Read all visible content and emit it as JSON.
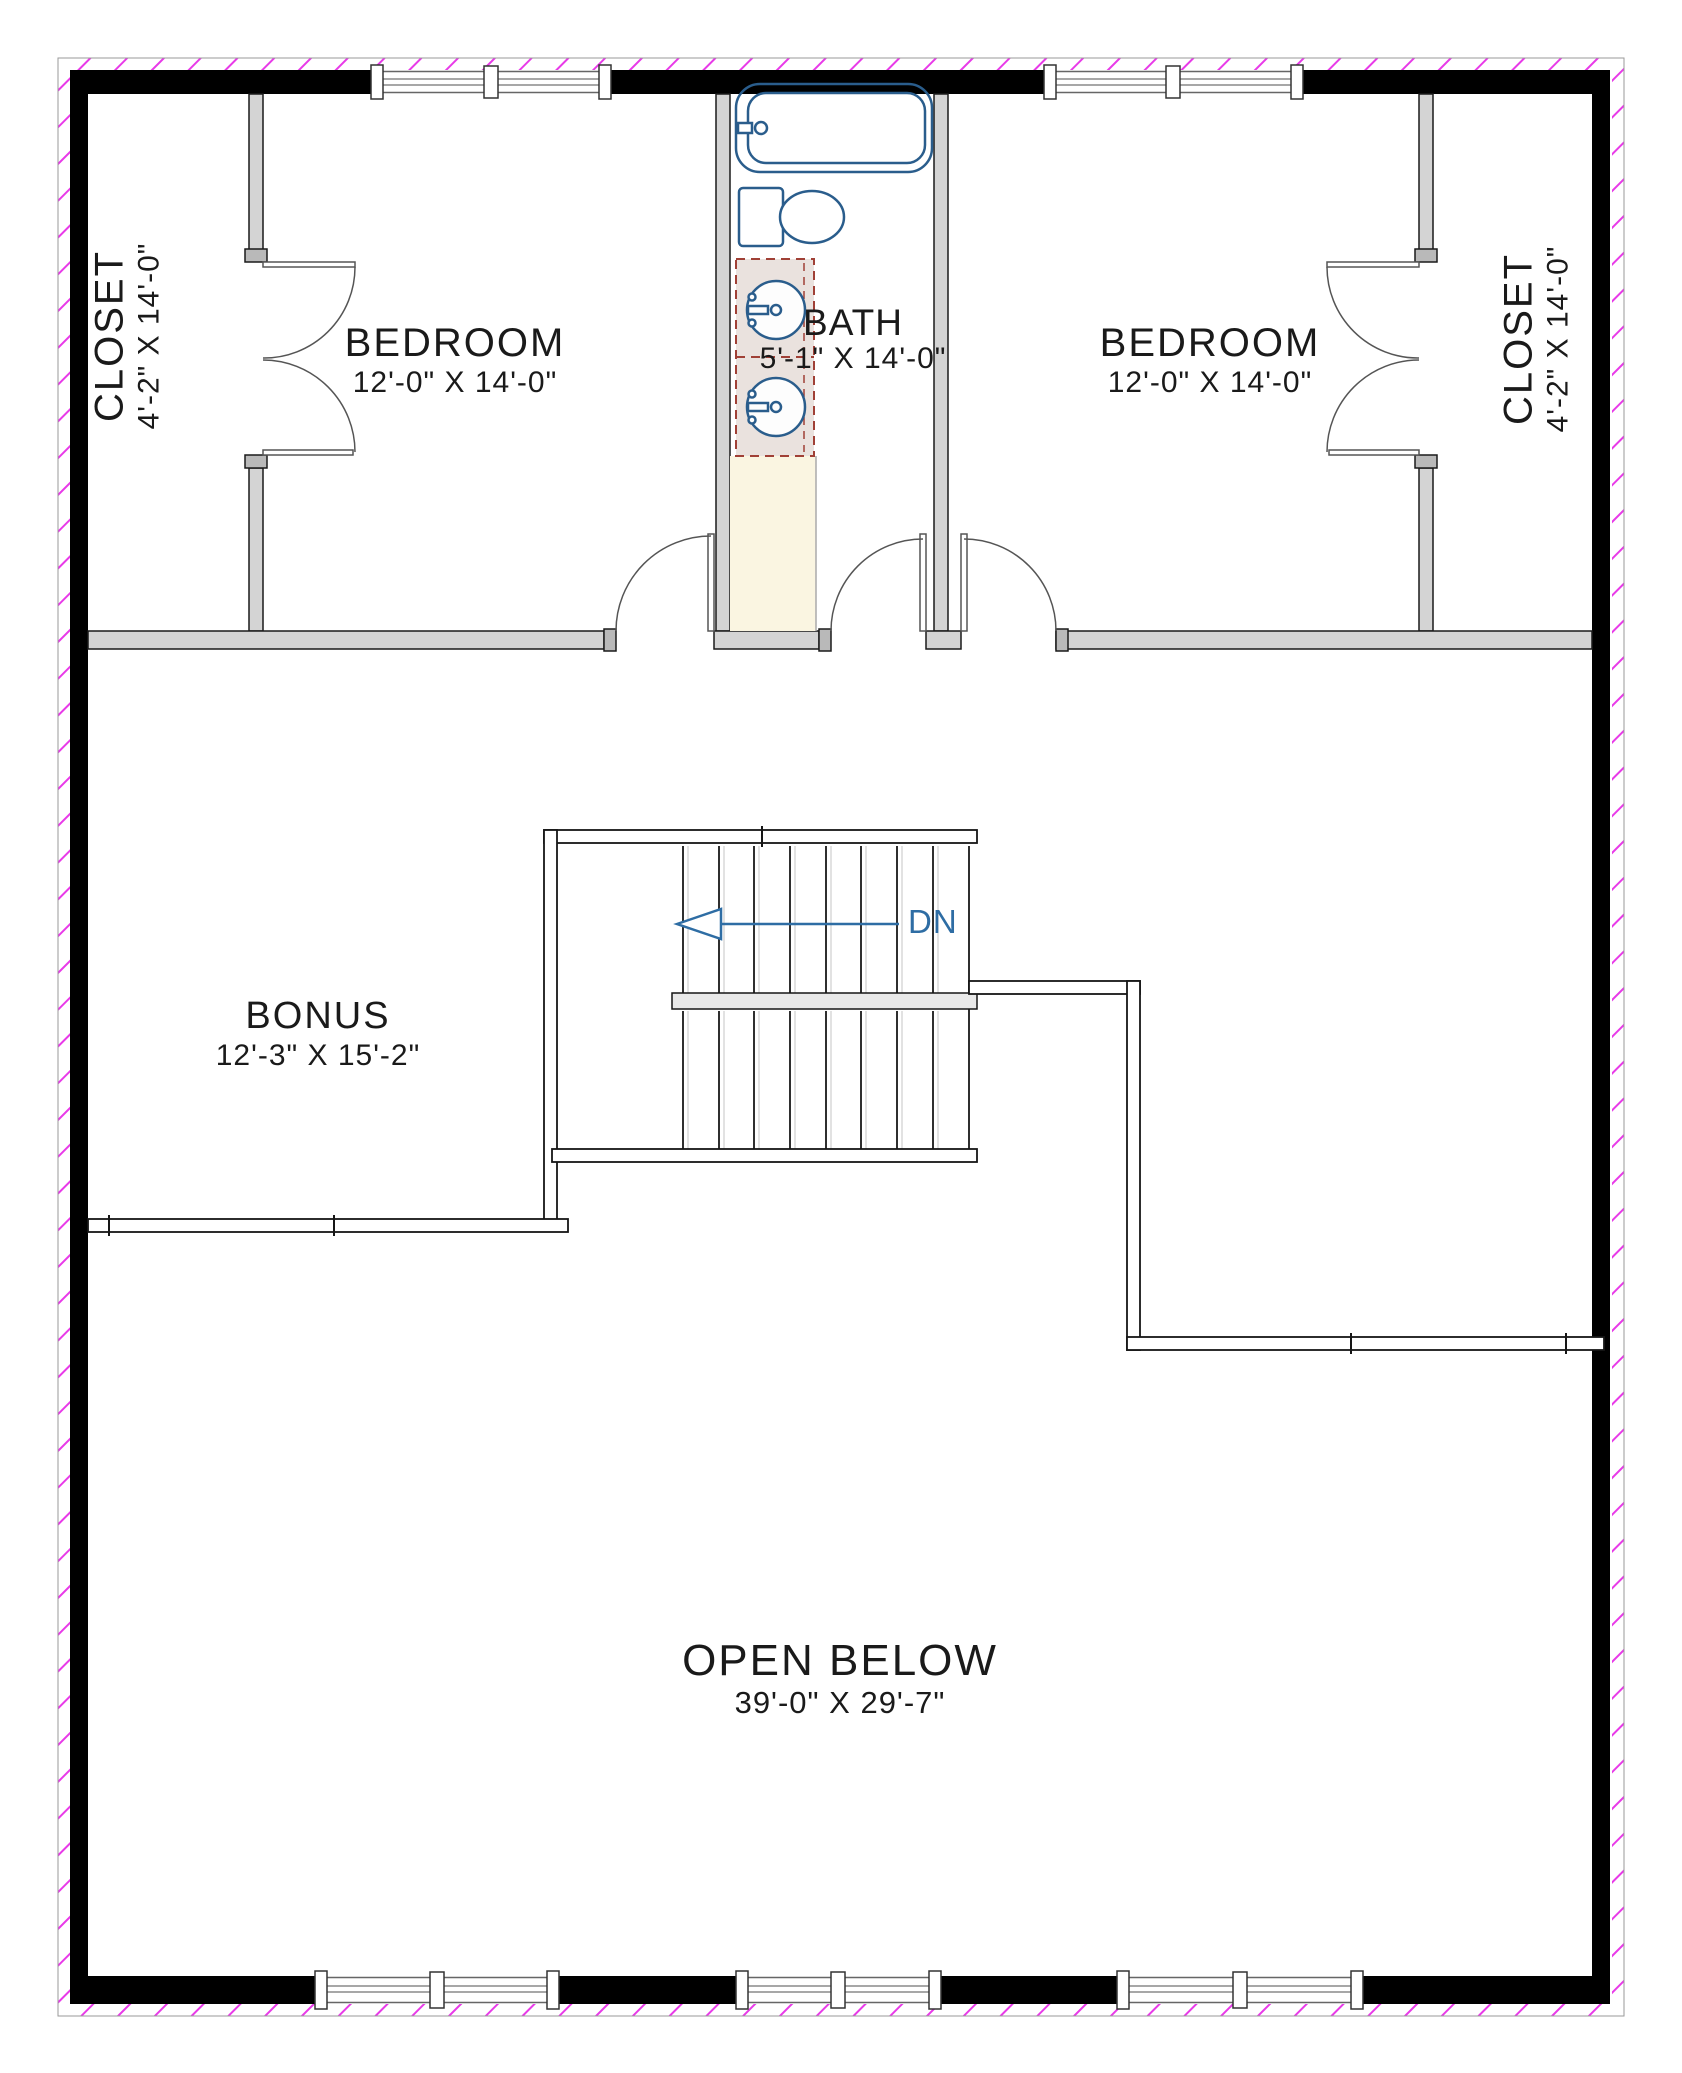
{
  "plan": {
    "rooms": {
      "closet_left": {
        "name": "CLOSET",
        "dims": "4'-2\" X 14'-0\""
      },
      "bedroom_left": {
        "name": "BEDROOM",
        "dims": "12'-0\" X 14'-0\""
      },
      "bath": {
        "name": "BATH",
        "dims": "5'-1\" X 14'-0\""
      },
      "bedroom_right": {
        "name": "BEDROOM",
        "dims": "12'-0\" X 14'-0\""
      },
      "closet_right": {
        "name": "CLOSET",
        "dims": "4'-2\" X 14'-0\""
      },
      "bonus": {
        "name": "BONUS",
        "dims": "12'-3\" X 15'-2\""
      },
      "open_below": {
        "name": "OPEN BELOW",
        "dims": "39'-0\" X 29'-7\""
      }
    },
    "stairs": {
      "direction_label": "DN"
    },
    "colors": {
      "wall": "#000000",
      "interior_wall": "#d4d4d4",
      "fixture_blue": "#2a5d8c",
      "vanity_outline": "#a04036",
      "vanity_fill": "#eae2de",
      "bath_floor_cream": "#faf5e1",
      "hatch_magenta": "#e83ae8",
      "stair_arrow_blue": "#2e6da4",
      "text": "#1a1a1a"
    }
  }
}
